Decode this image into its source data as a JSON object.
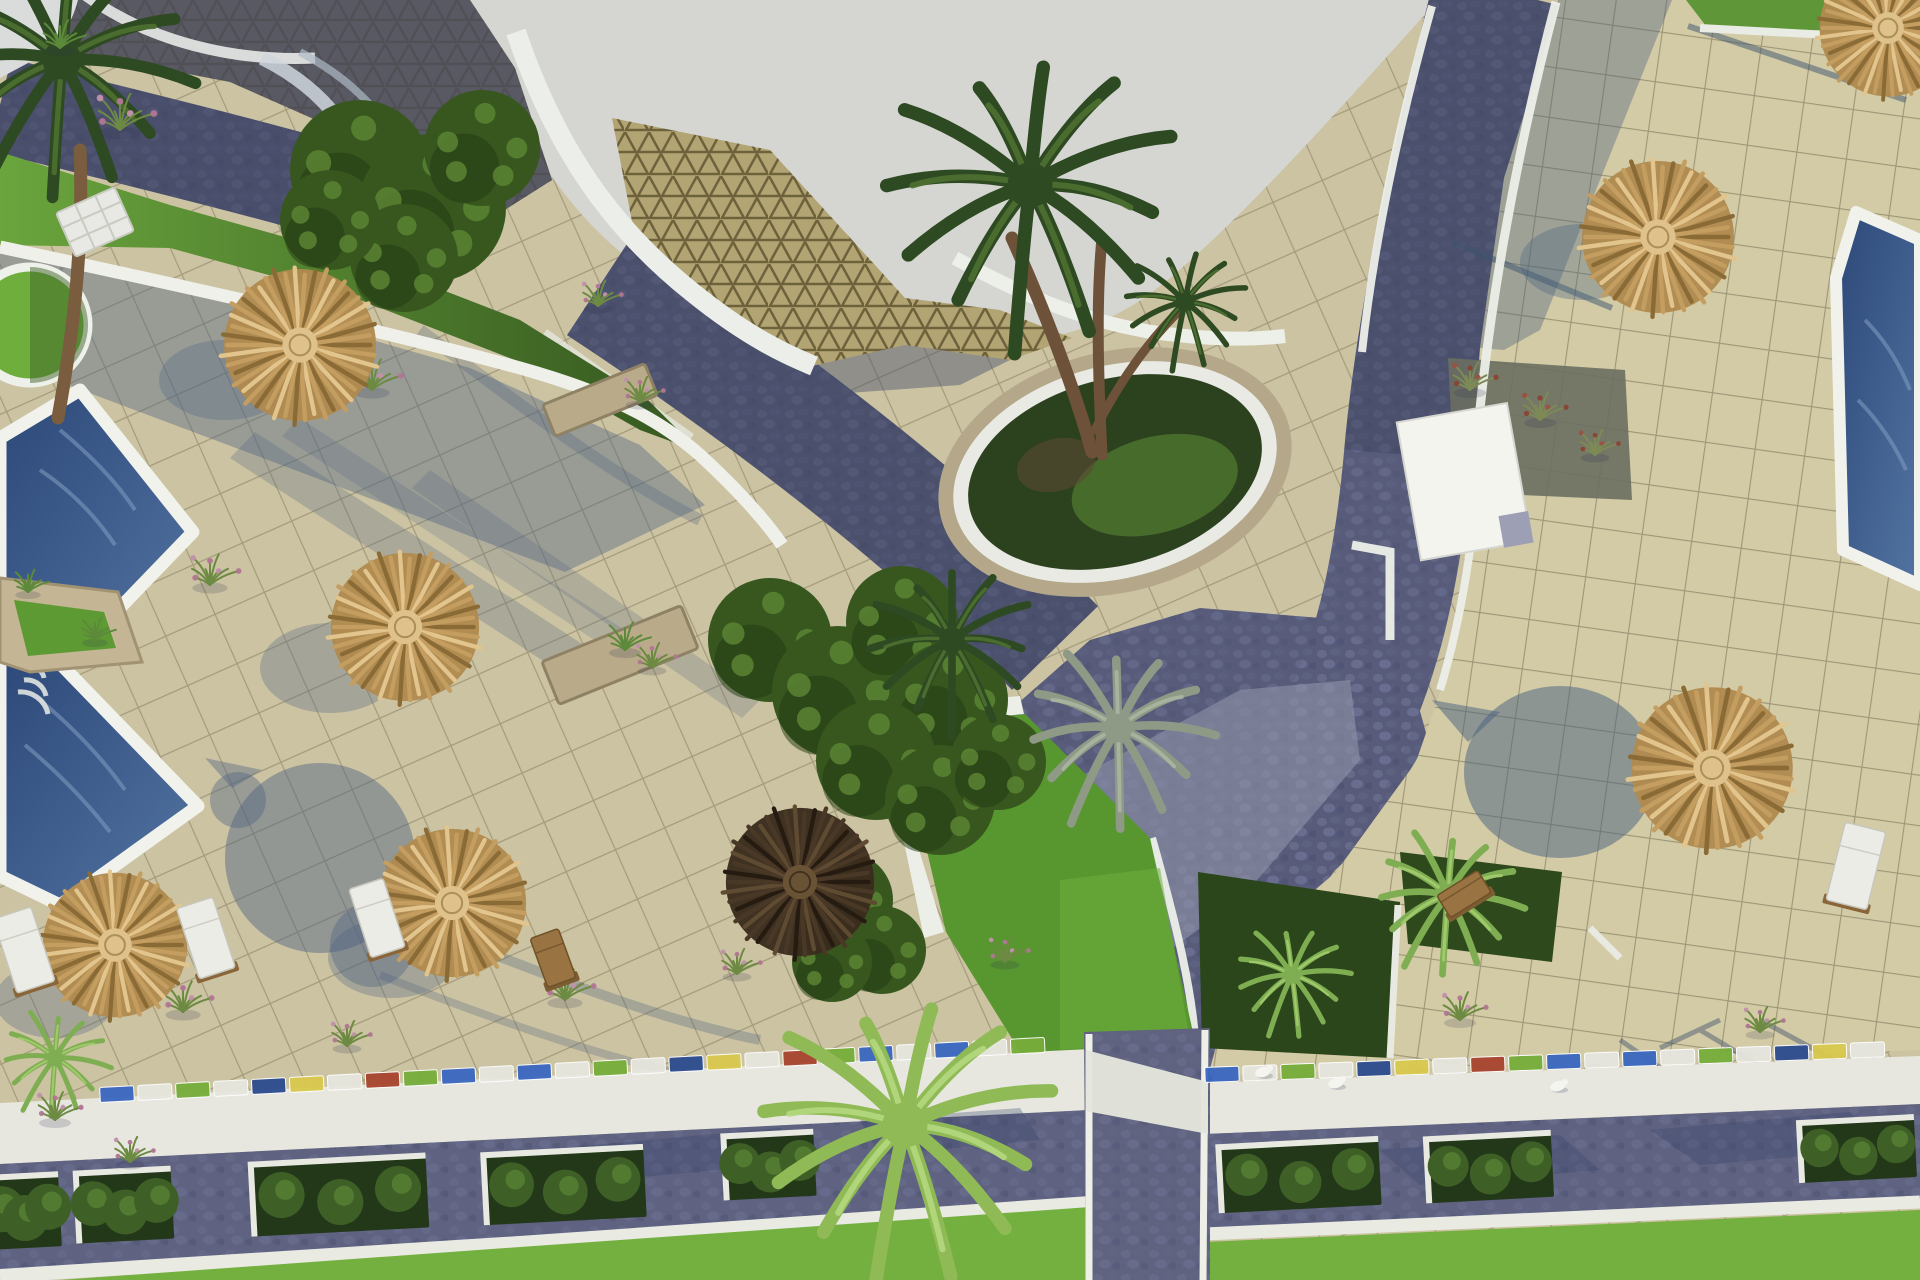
{
  "scene": {
    "kind": "aerial-3d-architectural-render",
    "subject": "resort pool terrace courtyard with thatched umbrellas, pools, palms and cobble pathways"
  },
  "palette": {
    "sky": "#d5d6d2",
    "tile_left": "#cbc3a2",
    "tile_right": "#d3cba6",
    "tile_grout": "#968d6f",
    "plaza_tan": "#b2a473",
    "plaza_line": "#6e623c",
    "cobble": "#585c7a",
    "cobble_sunlit": "#8f92a8",
    "cobble_shadow": "#2f3450",
    "white_wall": "#eceee9",
    "pool_deep": "#2c4878",
    "pool_light": "#5374a2",
    "lawn_bright": "#74b040",
    "lawn_shadow": "#3c5c28",
    "bush_dark": "#38571f",
    "stone": "#b9ab8a",
    "wood": "#8a6538",
    "umbrella": {
      "straw": {
        "base": "#b08a4f",
        "dark": "#8a6a35",
        "mid": "#c49d60",
        "light": "#e2c48d",
        "hub": "#dfc28b"
      },
      "dark": {
        "base": "#3a2c1d",
        "dark": "#261b10",
        "mid": "#4a3826",
        "light": "#5f4b32",
        "hub": "#6a5334"
      }
    },
    "lounger": {
      "white": {
        "pad": "#ecece6",
        "edge": "#c6c6bc",
        "wood": "#8a6538"
      },
      "wood": {
        "pad": "#9a7342",
        "edge": "#6f5128",
        "wood": "#7c5c33"
      }
    },
    "palm_tones": {
      "dark": {
        "main": "#2e4a22",
        "hi": "#4e7031"
      },
      "light": {
        "main": "#7fae52",
        "hi": "#a3cc6e"
      },
      "bright": {
        "main": "#8fba55",
        "hi": "#b5d87f"
      },
      "silver": {
        "main": "#8e9a85",
        "hi": "#aab5a2"
      }
    },
    "tuft": {
      "pink": {
        "stem": "#6d8a42",
        "tip1": "#c291ad",
        "tip2": "#b27695"
      },
      "green": {
        "stem": "#5d8a3a",
        "tip1": "#7fae52",
        "tip2": "#6d9a44"
      },
      "red": {
        "stem": "#7d8a55",
        "tip1": "#9c5040",
        "tip2": "#8a4234"
      }
    },
    "mosaic_colors": [
      "#3a67c0",
      "#e6e6df",
      "#76ad3a",
      "#e6e6df",
      "#2c4b8e",
      "#d9c94e",
      "#e6e6df",
      "#a8442f",
      "#76ad3a",
      "#3a67c0",
      "#e6e6df"
    ]
  },
  "objects": {
    "umbrellas": [
      {
        "x": 300,
        "y": 345,
        "r": 80,
        "style": "straw"
      },
      {
        "x": 405,
        "y": 627,
        "r": 78,
        "style": "straw"
      },
      {
        "x": 115,
        "y": 945,
        "r": 76,
        "style": "straw"
      },
      {
        "x": 452,
        "y": 903,
        "r": 78,
        "style": "straw"
      },
      {
        "x": 800,
        "y": 882,
        "r": 78,
        "style": "dark"
      },
      {
        "x": 1658,
        "y": 237,
        "r": 80,
        "style": "straw"
      },
      {
        "x": 1888,
        "y": 28,
        "r": 72,
        "style": "straw"
      },
      {
        "x": 1712,
        "y": 768,
        "r": 85,
        "style": "straw"
      }
    ],
    "loungers": [
      {
        "x": 24,
        "y": 950,
        "w": 40,
        "h": 78,
        "rot": -18,
        "style": "white"
      },
      {
        "x": 206,
        "y": 938,
        "w": 38,
        "h": 74,
        "rot": -18,
        "style": "white"
      },
      {
        "x": 377,
        "y": 918,
        "w": 36,
        "h": 72,
        "rot": -18,
        "style": "white"
      },
      {
        "x": 553,
        "y": 958,
        "w": 30,
        "h": 52,
        "rot": -20,
        "style": "wood"
      },
      {
        "x": 1856,
        "y": 866,
        "w": 42,
        "h": 80,
        "rot": 14,
        "style": "white"
      },
      {
        "x": 1464,
        "y": 894,
        "w": 48,
        "h": 26,
        "rot": -32,
        "style": "wood"
      }
    ],
    "palms": [
      {
        "x": 1030,
        "y": 185,
        "r": 150,
        "tone": "dark"
      },
      {
        "x": 1185,
        "y": 302,
        "r": 62,
        "tone": "dark"
      },
      {
        "x": 952,
        "y": 640,
        "r": 85,
        "tone": "dark"
      },
      {
        "x": 1118,
        "y": 728,
        "r": 95,
        "tone": "silver"
      },
      {
        "x": 1448,
        "y": 895,
        "r": 75,
        "tone": "light"
      },
      {
        "x": 1292,
        "y": 975,
        "r": 58,
        "tone": "light"
      },
      {
        "x": 905,
        "y": 1125,
        "r": 150,
        "tone": "bright"
      },
      {
        "x": 55,
        "y": 1058,
        "r": 55,
        "tone": "light"
      },
      {
        "x": 62,
        "y": 60,
        "r": 130,
        "tone": "dark"
      }
    ],
    "bushes": [
      {
        "x": 360,
        "y": 170,
        "r": 70
      },
      {
        "x": 432,
        "y": 208,
        "r": 74
      },
      {
        "x": 482,
        "y": 148,
        "r": 58
      },
      {
        "x": 404,
        "y": 258,
        "r": 54
      },
      {
        "x": 330,
        "y": 220,
        "r": 50
      },
      {
        "x": 770,
        "y": 640,
        "r": 62
      },
      {
        "x": 838,
        "y": 692,
        "r": 66
      },
      {
        "x": 902,
        "y": 622,
        "r": 56
      },
      {
        "x": 950,
        "y": 700,
        "r": 58
      },
      {
        "x": 876,
        "y": 760,
        "r": 60
      },
      {
        "x": 940,
        "y": 800,
        "r": 55
      },
      {
        "x": 998,
        "y": 762,
        "r": 48
      },
      {
        "x": 845,
        "y": 900,
        "r": 48
      },
      {
        "x": 882,
        "y": 950,
        "r": 44
      },
      {
        "x": 832,
        "y": 962,
        "r": 40
      }
    ],
    "planter_boxes": [
      {
        "x": 25,
        "y": 1212,
        "w": 70,
        "h": 72
      },
      {
        "x": 125,
        "y": 1206,
        "w": 95,
        "h": 70
      },
      {
        "x": 340,
        "y": 1196,
        "w": 175,
        "h": 72
      },
      {
        "x": 565,
        "y": 1186,
        "w": 160,
        "h": 70
      },
      {
        "x": 770,
        "y": 1166,
        "w": 90,
        "h": 64
      },
      {
        "x": 1300,
        "y": 1176,
        "w": 160,
        "h": 66
      },
      {
        "x": 1490,
        "y": 1168,
        "w": 125,
        "h": 64
      },
      {
        "x": 1858,
        "y": 1150,
        "w": 115,
        "h": 60
      }
    ],
    "tufts": [
      {
        "x": 120,
        "y": 130,
        "s": 1.3,
        "type": "pink"
      },
      {
        "x": 60,
        "y": 48,
        "s": 1.0,
        "type": "green"
      },
      {
        "x": 372,
        "y": 390,
        "s": 1.1,
        "type": "pink"
      },
      {
        "x": 598,
        "y": 306,
        "s": 0.9,
        "type": "pink"
      },
      {
        "x": 210,
        "y": 585,
        "s": 1.1,
        "type": "pink"
      },
      {
        "x": 640,
        "y": 402,
        "s": 0.9,
        "type": "pink"
      },
      {
        "x": 625,
        "y": 650,
        "s": 1.0,
        "type": "green"
      },
      {
        "x": 652,
        "y": 668,
        "s": 0.9,
        "type": "pink"
      },
      {
        "x": 183,
        "y": 1012,
        "s": 1.1,
        "type": "pink"
      },
      {
        "x": 347,
        "y": 1046,
        "s": 0.9,
        "type": "pink"
      },
      {
        "x": 565,
        "y": 1000,
        "s": 1.1,
        "type": "pink"
      },
      {
        "x": 737,
        "y": 974,
        "s": 0.9,
        "type": "pink"
      },
      {
        "x": 1005,
        "y": 962,
        "s": 0.9,
        "type": "pink"
      },
      {
        "x": 1460,
        "y": 1020,
        "s": 1.0,
        "type": "pink"
      },
      {
        "x": 1760,
        "y": 1032,
        "s": 0.9,
        "type": "pink"
      },
      {
        "x": 55,
        "y": 1120,
        "s": 1.0,
        "type": "pink"
      },
      {
        "x": 130,
        "y": 1162,
        "s": 0.9,
        "type": "pink"
      },
      {
        "x": 28,
        "y": 592,
        "s": 0.8,
        "type": "green"
      },
      {
        "x": 95,
        "y": 640,
        "s": 0.8,
        "type": "green"
      },
      {
        "x": 1470,
        "y": 390,
        "s": 1.0,
        "type": "red"
      },
      {
        "x": 1540,
        "y": 420,
        "s": 1.0,
        "type": "red"
      },
      {
        "x": 1595,
        "y": 455,
        "s": 0.9,
        "type": "red"
      }
    ],
    "birds": [
      {
        "x": 1263,
        "y": 1072
      },
      {
        "x": 1336,
        "y": 1083
      },
      {
        "x": 1558,
        "y": 1086
      }
    ],
    "mosaic_strips": [
      {
        "x1": 100,
        "y1": 1095,
        "x2": 1080,
        "y2": 1043
      },
      {
        "x1": 1205,
        "y1": 1075,
        "x2": 1920,
        "y2": 1048
      }
    ]
  }
}
